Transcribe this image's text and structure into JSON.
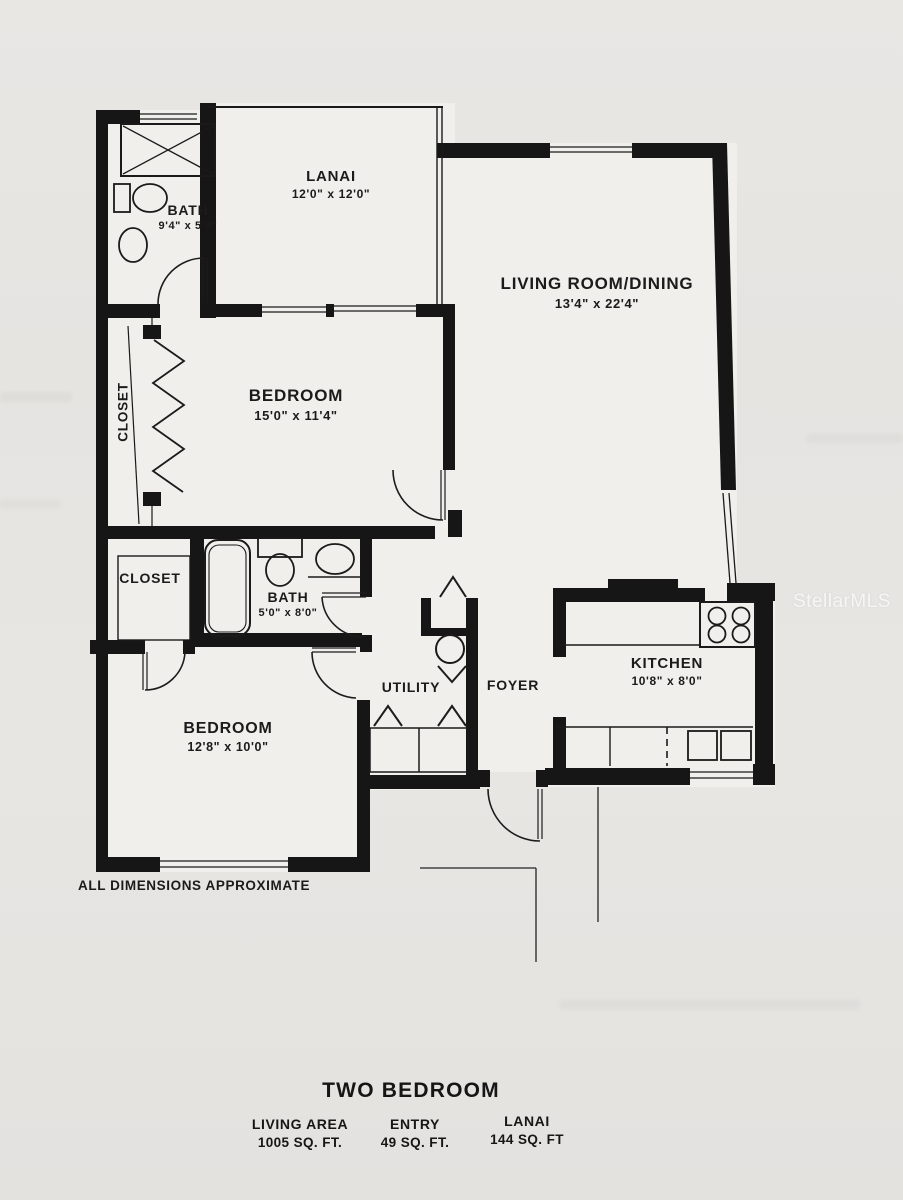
{
  "watermark": "StellarMLS",
  "floorplan": {
    "note": "ALL DIMENSIONS APPROXIMATE",
    "rooms": {
      "bath1": {
        "label": "BATH",
        "dims": "9'4\" x 5'0\""
      },
      "lanai": {
        "label": "LANAI",
        "dims": "12'0\" x 12'0\""
      },
      "living": {
        "label": "LIVING ROOM/DINING",
        "dims": "13'4\" x 22'4\""
      },
      "closet1": {
        "label": "CLOSET"
      },
      "bedroom1": {
        "label": "BEDROOM",
        "dims": "15'0\" x 11'4\""
      },
      "closet2": {
        "label": "CLOSET"
      },
      "bath2": {
        "label": "BATH",
        "dims": "5'0\" x 8'0\""
      },
      "utility": {
        "label": "UTILITY"
      },
      "foyer": {
        "label": "FOYER"
      },
      "kitchen": {
        "label": "KITCHEN",
        "dims": "10'8\" x 8'0\""
      },
      "bedroom2": {
        "label": "BEDROOM",
        "dims": "12'8\" x 10'0\""
      }
    }
  },
  "footer": {
    "title": "TWO BEDROOM",
    "areas": [
      {
        "name": "LIVING AREA",
        "value": "1005 SQ. FT."
      },
      {
        "name": "ENTRY",
        "value": "49 SQ. FT."
      },
      {
        "name": "LANAI",
        "value": "144 SQ. FT"
      }
    ]
  },
  "colors": {
    "ink": "#1a1a1a",
    "paper": "#e7e5e2",
    "plan_paper": "#f1efeb",
    "watermark": "#fcfcfb"
  }
}
